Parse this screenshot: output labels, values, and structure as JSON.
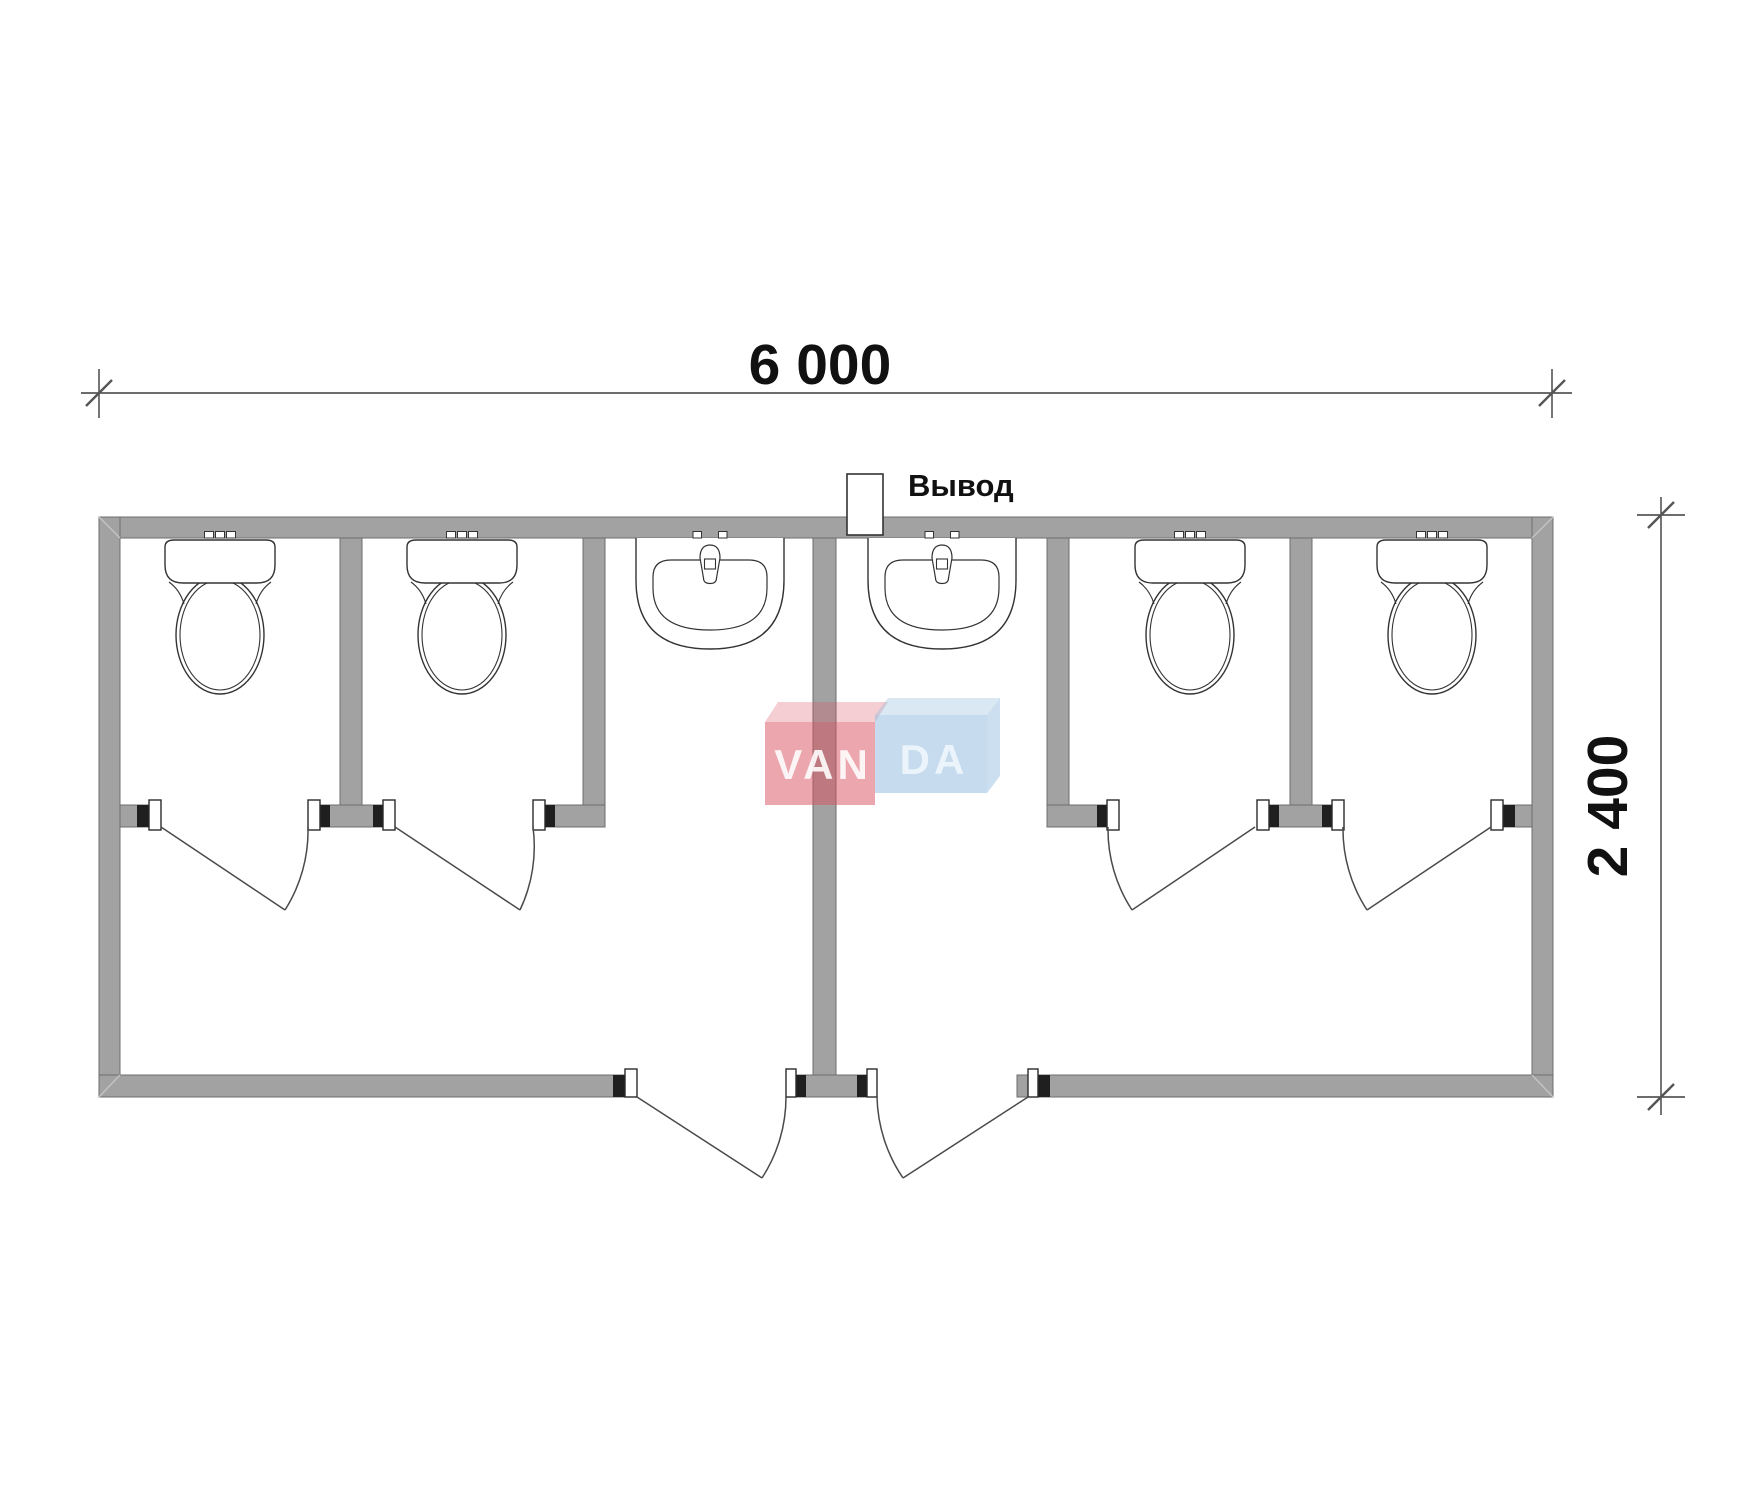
{
  "drawing": {
    "type": "architectural-floor-plan",
    "subject": "modular sanitary container, plan view",
    "stalls": [
      {
        "name": "wc-stall-1",
        "fixture": "toilet"
      },
      {
        "name": "wc-stall-2",
        "fixture": "toilet"
      },
      {
        "name": "wc-stall-3",
        "fixture": "toilet"
      },
      {
        "name": "wc-stall-4",
        "fixture": "toilet"
      }
    ],
    "washrooms": [
      {
        "name": "washroom-left",
        "fixture": "washbasin"
      },
      {
        "name": "washroom-right",
        "fixture": "washbasin"
      }
    ],
    "doors": 6
  },
  "dimensions": {
    "width_label": "6 000",
    "height_label": "2 400",
    "width_mm": 6000,
    "height_mm": 2400
  },
  "labels": {
    "outlet": "Вывод"
  },
  "logo": {
    "name": "VANDA",
    "part1": "VAN",
    "part2": "DA"
  },
  "colors": {
    "wall": "#a2a2a2",
    "wall_outline": "#6e6e6e",
    "cap": "#1f1f1f",
    "fixture_line": "#333333",
    "door_line": "#4a4a4a",
    "dim_line": "#3c3c3c",
    "logo_red": "#d94f5e",
    "logo_blue": "#8db8dd"
  }
}
